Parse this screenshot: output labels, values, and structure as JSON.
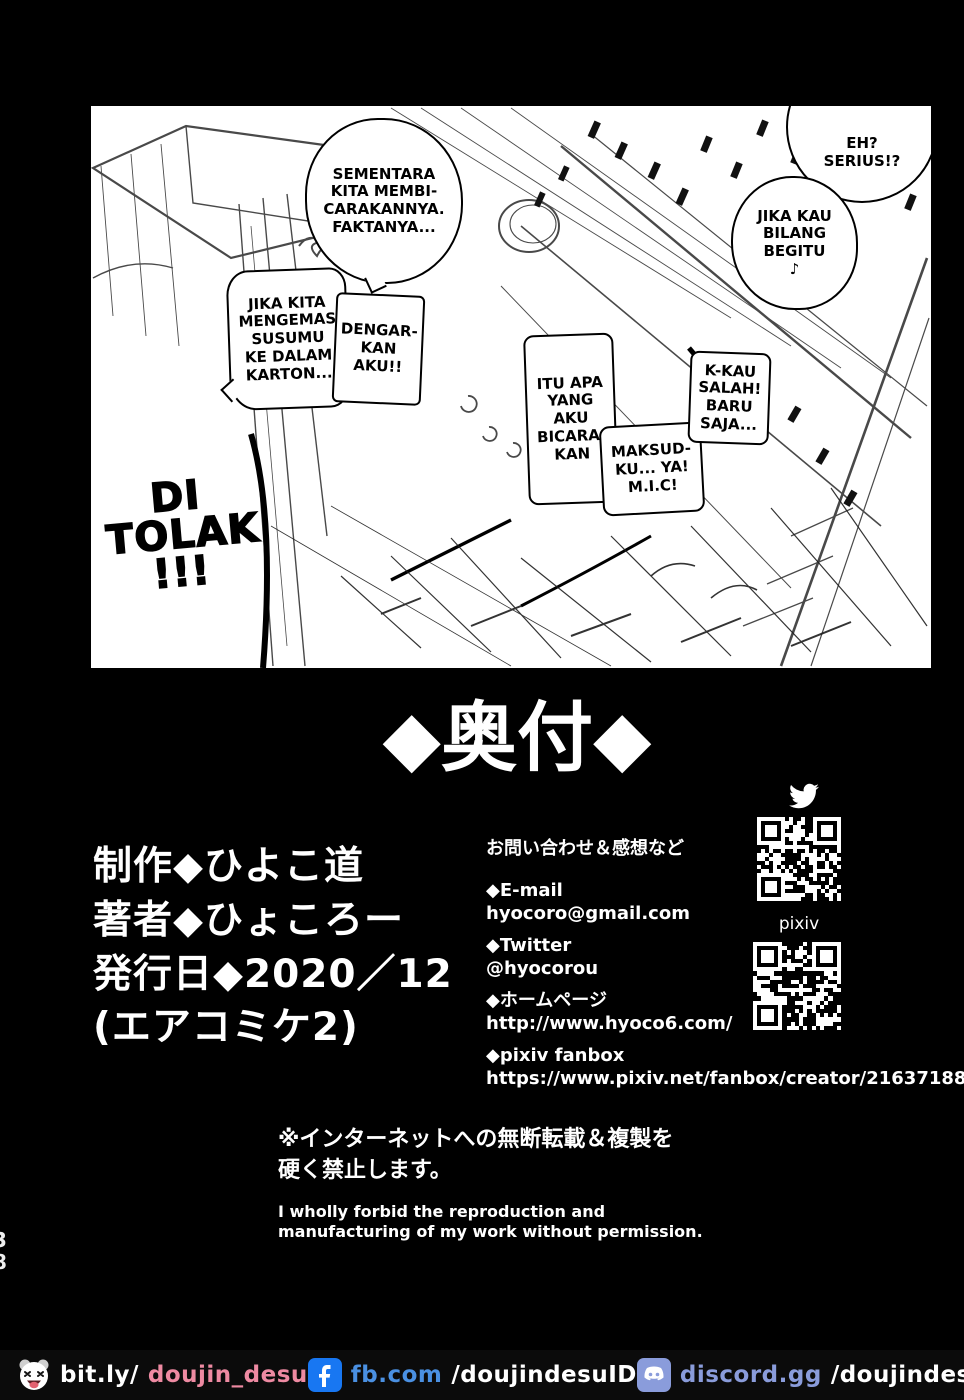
{
  "manga": {
    "bubbles": [
      {
        "text": "SEMENTARA\nKITA MEMBI-\nCARAKANNYA.\nFAKTANYA..."
      },
      {
        "text": "EH?\nSERIUS!?"
      },
      {
        "text": "JIKA KAU\nBILANG\nBEGITU\n♪"
      },
      {
        "text": "JIKA KITA\nMENGEMAS\nSUSUMU\nKE DALAM\nKARTON..."
      },
      {
        "text": "DENGAR-\nKAN\nAKU!!"
      },
      {
        "text": "ITU APA\nYANG\nAKU\nBICARA-\nKAN"
      },
      {
        "text": "MAKSUD-\nKU... YA!\nM.I.C!"
      },
      {
        "text": "K-KAU\nSALAH!\nBARU\nSAJA..."
      }
    ],
    "sfx_di_tolak": "DI\nTOLAK\n!!!"
  },
  "colophon": {
    "title": "◆奥付◆",
    "credits": [
      "制作◆ひよこ道",
      "著者◆ひょころー",
      "発行日◆2020／12",
      "(エアコミケ2)"
    ],
    "contact": {
      "heading": "お問い合わせ＆感想など",
      "items": [
        {
          "label": "◆E-mail",
          "value": "hyocoro@gmail.com"
        },
        {
          "label": "◆Twitter",
          "value": "@hyocorou"
        },
        {
          "label": "◆ホームページ",
          "value": "http://www.hyoco6.com/"
        },
        {
          "label": "◆pixiv fanbox",
          "value": "https://www.pixiv.net/fanbox/creator/21637188"
        }
      ]
    },
    "qr": {
      "twitter_icon": "twitter-bird-icon",
      "pixiv_label": "pixiv"
    },
    "notice_jp": "※インターネットへの無断転載＆複製を\n硬く禁止します。",
    "notice_en": "I wholly forbid the reproduction and\nmanufacturing of my work without permission."
  },
  "page_number": "38",
  "footer": {
    "items": [
      {
        "icon": "panda-icon",
        "prefix": "bit.ly/",
        "handle": "doujin_desu",
        "prefix_color": "#ffffff",
        "handle_color": "#ee8aa2"
      },
      {
        "icon": "facebook-icon",
        "prefix": "fb.com",
        "handle": "/doujindesuID",
        "prefix_color": "#4a90e2",
        "handle_color": "#ffffff"
      },
      {
        "icon": "discord-icon",
        "prefix": "discord.gg",
        "handle": "/doujindesu",
        "prefix_color": "#8a9cdb",
        "handle_color": "#ffffff"
      },
      {
        "icon": "instagram-icon",
        "prefix": "@",
        "handle": "dou_desu",
        "prefix_color": "#e05252",
        "handle_color": "#ffffff"
      }
    ]
  },
  "colors": {
    "facebook_blue": "#1877f2",
    "discord_lavender": "#8a9cdb",
    "footer_pink": "#ee8aa2",
    "instagram_red": "#e05252",
    "page_background": "#000000",
    "panel_background": "#ffffff"
  }
}
